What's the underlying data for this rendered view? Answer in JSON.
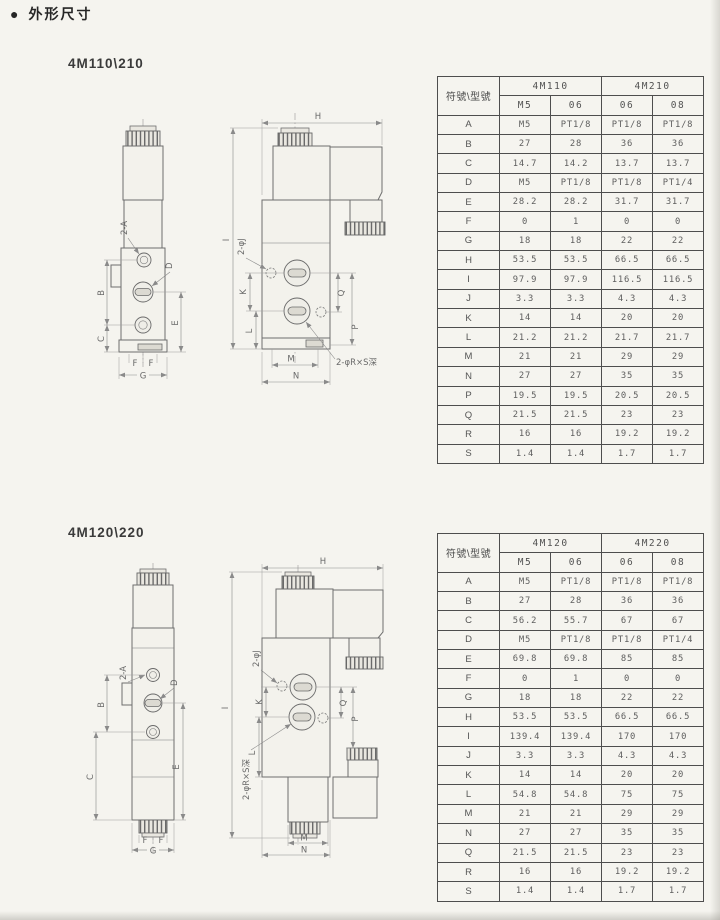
{
  "page": {
    "bullet": "●",
    "heading": "外形尺寸"
  },
  "dim_labels": {
    "a2": "2-A",
    "d": "D",
    "b": "B",
    "c": "C",
    "e": "E",
    "f": "F",
    "g": "G",
    "h": "H",
    "i": "I",
    "j2": "2-φJ",
    "k": "K",
    "l": "L",
    "m": "M",
    "n": "N",
    "p": "P",
    "q": "Q",
    "rs": "2-φR×S深"
  },
  "section1": {
    "title": "4M110\\210",
    "table": {
      "corner": "符號\\型號",
      "groups": [
        {
          "label": "4M110",
          "cols": [
            "M5",
            "06"
          ]
        },
        {
          "label": "4M210",
          "cols": [
            "06",
            "08"
          ]
        }
      ],
      "rows": [
        {
          "sym": "A",
          "values": [
            "M5",
            "PT1/8",
            "PT1/8",
            "PT1/8"
          ]
        },
        {
          "sym": "B",
          "values": [
            "27",
            "28",
            "36",
            "36"
          ]
        },
        {
          "sym": "C",
          "values": [
            "14.7",
            "14.2",
            "13.7",
            "13.7"
          ]
        },
        {
          "sym": "D",
          "values": [
            "M5",
            "PT1/8",
            "PT1/8",
            "PT1/4"
          ]
        },
        {
          "sym": "E",
          "values": [
            "28.2",
            "28.2",
            "31.7",
            "31.7"
          ]
        },
        {
          "sym": "F",
          "values": [
            "0",
            "1",
            "0",
            "0"
          ]
        },
        {
          "sym": "G",
          "values": [
            "18",
            "18",
            "22",
            "22"
          ]
        },
        {
          "sym": "H",
          "values": [
            "53.5",
            "53.5",
            "66.5",
            "66.5"
          ]
        },
        {
          "sym": "I",
          "values": [
            "97.9",
            "97.9",
            "116.5",
            "116.5"
          ]
        },
        {
          "sym": "J",
          "values": [
            "3.3",
            "3.3",
            "4.3",
            "4.3"
          ]
        },
        {
          "sym": "K",
          "values": [
            "14",
            "14",
            "20",
            "20"
          ]
        },
        {
          "sym": "L",
          "values": [
            "21.2",
            "21.2",
            "21.7",
            "21.7"
          ]
        },
        {
          "sym": "M",
          "values": [
            "21",
            "21",
            "29",
            "29"
          ]
        },
        {
          "sym": "N",
          "values": [
            "27",
            "27",
            "35",
            "35"
          ]
        },
        {
          "sym": "P",
          "values": [
            "19.5",
            "19.5",
            "20.5",
            "20.5"
          ]
        },
        {
          "sym": "Q",
          "values": [
            "21.5",
            "21.5",
            "23",
            "23"
          ]
        },
        {
          "sym": "R",
          "values": [
            "16",
            "16",
            "19.2",
            "19.2"
          ]
        },
        {
          "sym": "S",
          "values": [
            "1.4",
            "1.4",
            "1.7",
            "1.7"
          ]
        }
      ]
    }
  },
  "section2": {
    "title": "4M120\\220",
    "table": {
      "corner": "符號\\型號",
      "groups": [
        {
          "label": "4M120",
          "cols": [
            "M5",
            "06"
          ]
        },
        {
          "label": "4M220",
          "cols": [
            "06",
            "08"
          ]
        }
      ],
      "rows": [
        {
          "sym": "A",
          "values": [
            "M5",
            "PT1/8",
            "PT1/8",
            "PT1/8"
          ]
        },
        {
          "sym": "B",
          "values": [
            "27",
            "28",
            "36",
            "36"
          ]
        },
        {
          "sym": "C",
          "values": [
            "56.2",
            "55.7",
            "67",
            "67"
          ]
        },
        {
          "sym": "D",
          "values": [
            "M5",
            "PT1/8",
            "PT1/8",
            "PT1/4"
          ]
        },
        {
          "sym": "E",
          "values": [
            "69.8",
            "69.8",
            "85",
            "85"
          ]
        },
        {
          "sym": "F",
          "values": [
            "0",
            "1",
            "0",
            "0"
          ]
        },
        {
          "sym": "G",
          "values": [
            "18",
            "18",
            "22",
            "22"
          ]
        },
        {
          "sym": "H",
          "values": [
            "53.5",
            "53.5",
            "66.5",
            "66.5"
          ]
        },
        {
          "sym": "I",
          "values": [
            "139.4",
            "139.4",
            "170",
            "170"
          ]
        },
        {
          "sym": "J",
          "values": [
            "3.3",
            "3.3",
            "4.3",
            "4.3"
          ]
        },
        {
          "sym": "K",
          "values": [
            "14",
            "14",
            "20",
            "20"
          ]
        },
        {
          "sym": "L",
          "values": [
            "54.8",
            "54.8",
            "75",
            "75"
          ]
        },
        {
          "sym": "M",
          "values": [
            "21",
            "21",
            "29",
            "29"
          ]
        },
        {
          "sym": "N",
          "values": [
            "27",
            "27",
            "35",
            "35"
          ]
        },
        {
          "sym": "Q",
          "values": [
            "21.5",
            "21.5",
            "23",
            "23"
          ]
        },
        {
          "sym": "R",
          "values": [
            "16",
            "16",
            "19.2",
            "19.2"
          ]
        },
        {
          "sym": "S",
          "values": [
            "1.4",
            "1.4",
            "1.7",
            "1.7"
          ]
        }
      ]
    }
  }
}
